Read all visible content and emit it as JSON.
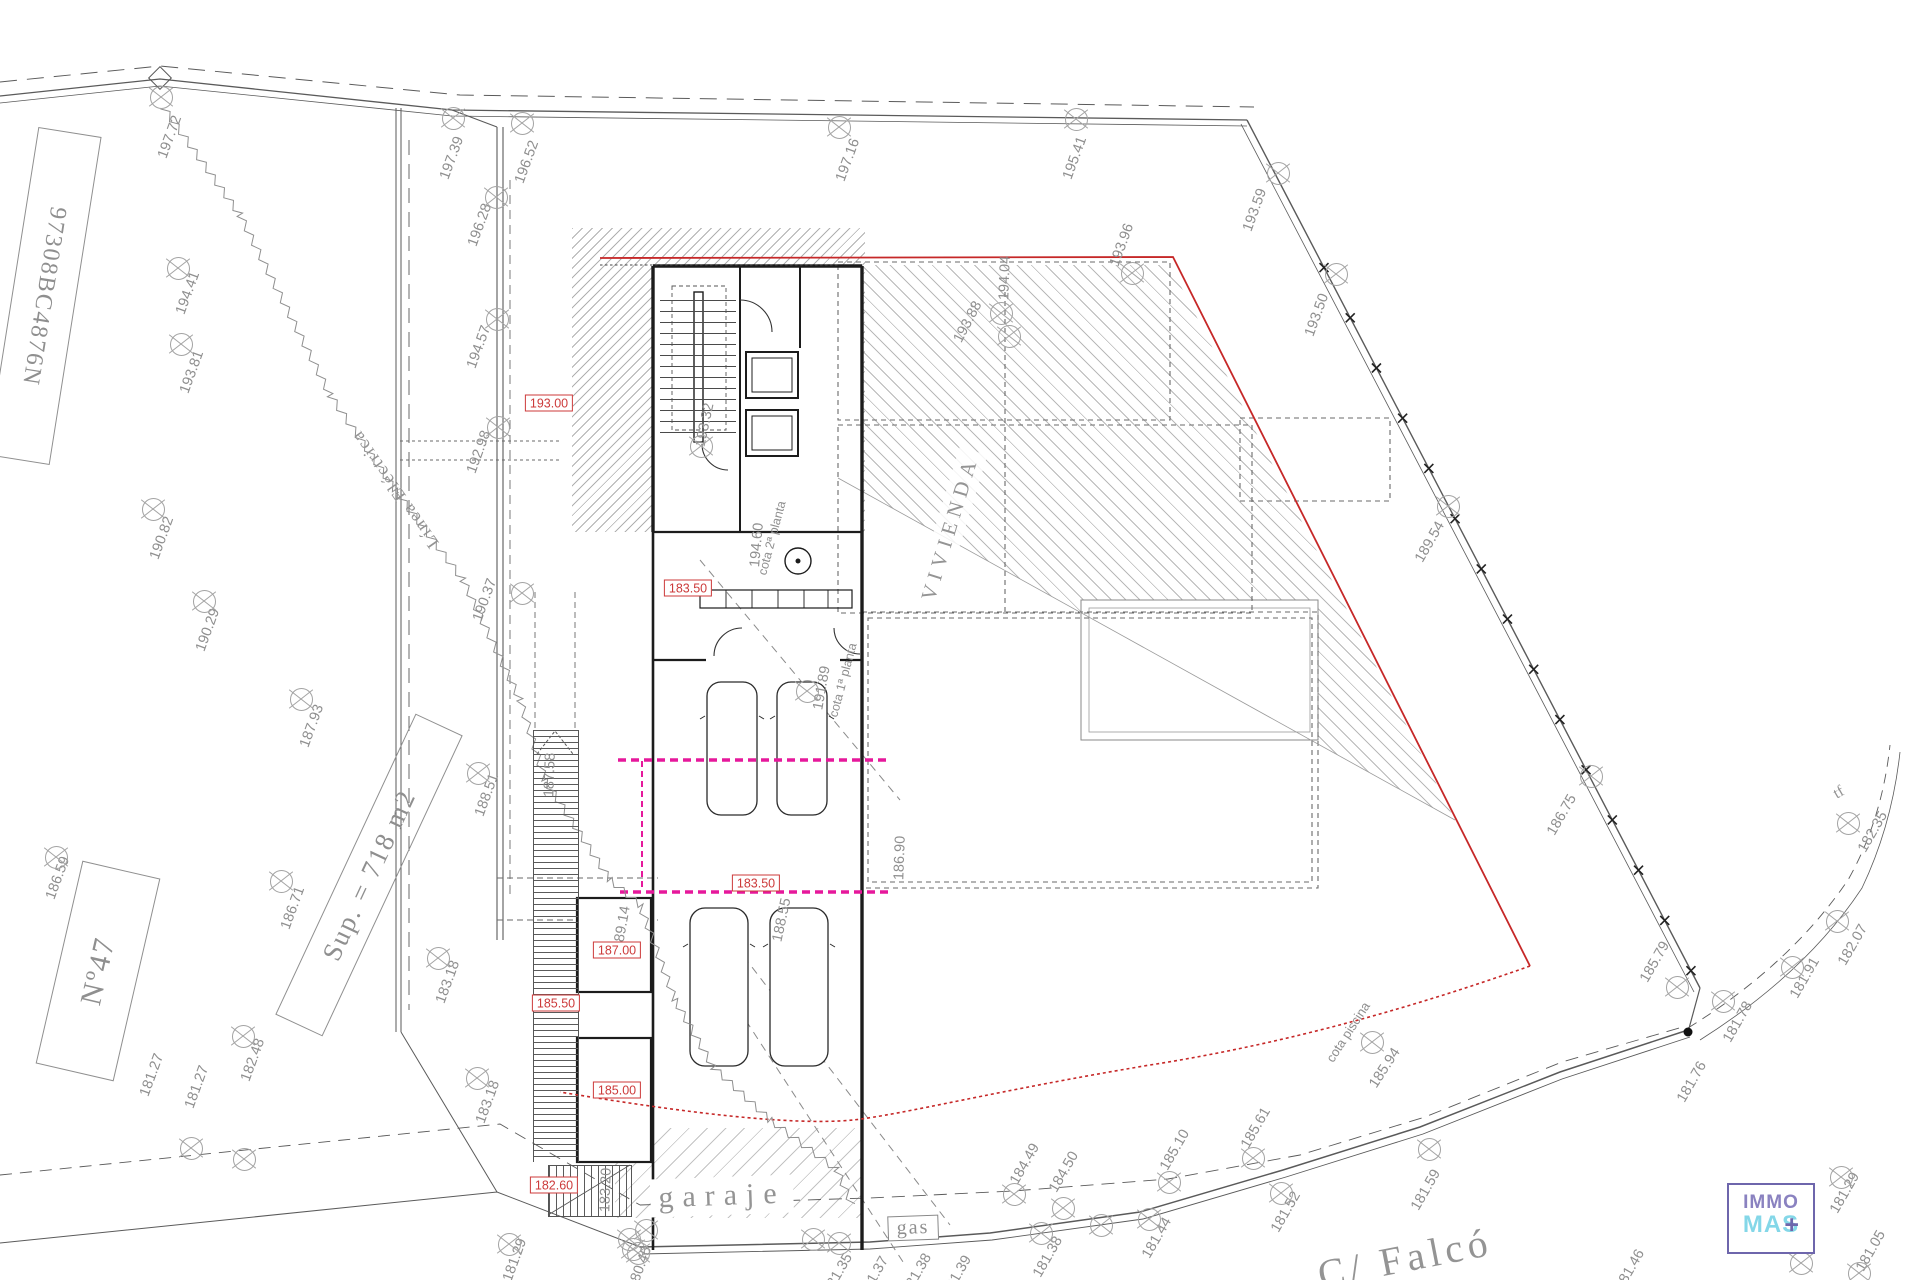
{
  "texts": {
    "vivienda": "VIVIENDA",
    "garaje": "garaje",
    "gas": "gas",
    "street": "C/ Falcó",
    "linea_electrica": "Línea Eléctrica",
    "cota_piscina": "cota piscina",
    "cota_1": "cota 1ª planta",
    "cota_2": "cota 2ª planta",
    "sup": "Sup. = 718 m2",
    "parcel_no": "Nº47",
    "cadastral": "97308BC4876N",
    "tf": "tf"
  },
  "logo": {
    "top": "IMMO",
    "bottom": "MAS",
    "plus": "+"
  },
  "colors": {
    "red": "#c62828",
    "magenta": "#e6189b",
    "label_gray": "#8f8f8f",
    "logo_purple": "#7c74b8",
    "logo_cyan": "#84d7e8"
  },
  "red_levels": [
    {
      "t": "193.00",
      "x": 549,
      "y": 403
    },
    {
      "t": "183.50",
      "x": 688,
      "y": 588
    },
    {
      "t": "183.50",
      "x": 756,
      "y": 883
    },
    {
      "t": "187.00",
      "x": 617,
      "y": 950
    },
    {
      "t": "185.50",
      "x": 556,
      "y": 1003
    },
    {
      "t": "185.00",
      "x": 617,
      "y": 1090
    },
    {
      "t": "182.60",
      "x": 554,
      "y": 1185
    }
  ],
  "elevations": [
    {
      "t": "197.72",
      "x": 170,
      "y": 137,
      "r": -70,
      "mx": 160,
      "my": 96
    },
    {
      "t": "197.39",
      "x": 452,
      "y": 158,
      "r": -70,
      "mx": 452,
      "my": 117
    },
    {
      "t": "196.52",
      "x": 527,
      "y": 162,
      "r": -70,
      "mx": 521,
      "my": 122
    },
    {
      "t": "196.28",
      "x": 480,
      "y": 225,
      "r": -70,
      "mx": 495,
      "my": 196
    },
    {
      "t": "197.16",
      "x": 848,
      "y": 160,
      "r": -70,
      "mx": 838,
      "my": 126
    },
    {
      "t": "195.41",
      "x": 1075,
      "y": 158,
      "r": -70,
      "mx": 1075,
      "my": 118
    },
    {
      "t": "193.59",
      "x": 1255,
      "y": 210,
      "r": -70,
      "mx": 1277,
      "my": 172
    },
    {
      "t": "193.50",
      "x": 1317,
      "y": 315,
      "r": -70,
      "mx": 1335,
      "my": 273
    },
    {
      "t": "194.41",
      "x": 188,
      "y": 293,
      "r": -70,
      "mx": 177,
      "my": 267
    },
    {
      "t": "193.81",
      "x": 192,
      "y": 372,
      "r": -70,
      "mx": 180,
      "my": 343
    },
    {
      "t": "194.57",
      "x": 479,
      "y": 347,
      "r": -70,
      "mx": 496,
      "my": 318
    },
    {
      "t": "192.98",
      "x": 479,
      "y": 452,
      "r": -70,
      "mx": 497,
      "my": 426
    },
    {
      "t": "190.82",
      "x": 162,
      "y": 538,
      "r": -70,
      "mx": 152,
      "my": 508
    },
    {
      "t": "190.29",
      "x": 208,
      "y": 630,
      "r": -70,
      "mx": 203,
      "my": 600
    },
    {
      "t": "190.37",
      "x": 485,
      "y": 600,
      "r": -70,
      "mx": 521,
      "my": 592
    },
    {
      "t": "187.93",
      "x": 312,
      "y": 726,
      "r": -70,
      "mx": 300,
      "my": 698
    },
    {
      "t": "188.51",
      "x": 487,
      "y": 795,
      "r": -70,
      "mx": 477,
      "my": 772
    },
    {
      "t": "186.59",
      "x": 58,
      "y": 878,
      "r": -70,
      "mx": 55,
      "my": 856
    },
    {
      "t": "186.71",
      "x": 293,
      "y": 908,
      "r": -70,
      "mx": 280,
      "my": 880
    },
    {
      "t": "182.48",
      "x": 253,
      "y": 1060,
      "r": -70,
      "mx": 242,
      "my": 1035
    },
    {
      "t": "183.18",
      "x": 448,
      "y": 982,
      "r": -70,
      "mx": 437,
      "my": 957
    },
    {
      "t": "183.18",
      "x": 488,
      "y": 1102,
      "r": -70,
      "mx": 476,
      "my": 1077
    },
    {
      "t": "181.27",
      "x": 152,
      "y": 1075,
      "r": -70,
      "mx": 190,
      "my": 1147
    },
    {
      "t": "181.27",
      "x": 197,
      "y": 1087,
      "r": -70,
      "mx": 243,
      "my": 1158
    },
    {
      "t": "181.29",
      "x": 515,
      "y": 1260,
      "r": -70,
      "mx": 508,
      "my": 1243
    },
    {
      "t": "180.45",
      "x": 640,
      "y": 1268,
      "r": -70,
      "mx": 632,
      "my": 1248
    },
    {
      "t": "183.20",
      "x": 606,
      "y": 1190,
      "r": -88
    },
    {
      "t": "189.14",
      "x": 622,
      "y": 928,
      "r": -80
    },
    {
      "t": "188.55",
      "x": 782,
      "y": 920,
      "r": -78
    },
    {
      "t": "186.90",
      "x": 900,
      "y": 858,
      "r": -88
    },
    {
      "t": "187.58",
      "x": 550,
      "y": 775,
      "r": -88
    },
    {
      "t": "193.32",
      "x": 705,
      "y": 425,
      "r": -78,
      "mx": 700,
      "my": 445
    },
    {
      "t": "194.60",
      "x": 757,
      "y": 545,
      "r": -85
    },
    {
      "t": "191.89",
      "x": 822,
      "y": 688,
      "r": -80,
      "mx": 806,
      "my": 690
    },
    {
      "t": "193.88",
      "x": 968,
      "y": 322,
      "r": -62,
      "mx": 1000,
      "my": 312
    },
    {
      "t": "194.04",
      "x": 1005,
      "y": 278,
      "r": -88,
      "mx": 1008,
      "my": 335
    },
    {
      "t": "193.96",
      "x": 1122,
      "y": 245,
      "r": -70,
      "mx": 1131,
      "my": 272
    },
    {
      "t": "189.54",
      "x": 1430,
      "y": 542,
      "r": -60,
      "mx": 1447,
      "my": 505
    },
    {
      "t": "186.75",
      "x": 1562,
      "y": 815,
      "r": -60,
      "mx": 1590,
      "my": 775
    },
    {
      "t": "185.79",
      "x": 1655,
      "y": 962,
      "r": -60,
      "mx": 1676,
      "my": 986
    },
    {
      "t": "181.78",
      "x": 1738,
      "y": 1022,
      "r": -60,
      "mx": 1722,
      "my": 1000
    },
    {
      "t": "181.76",
      "x": 1692,
      "y": 1082,
      "r": -60
    },
    {
      "t": "181.91",
      "x": 1805,
      "y": 978,
      "r": -60,
      "mx": 1791,
      "my": 966
    },
    {
      "t": "182.07",
      "x": 1853,
      "y": 945,
      "r": -60,
      "mx": 1836,
      "my": 920
    },
    {
      "t": "182.35",
      "x": 1873,
      "y": 832,
      "r": -60,
      "mx": 1847,
      "my": 822
    },
    {
      "t": "185.94",
      "x": 1385,
      "y": 1068,
      "r": -57,
      "mx": 1371,
      "my": 1041
    },
    {
      "t": "184.49",
      "x": 1025,
      "y": 1164,
      "r": -60,
      "mx": 1013,
      "my": 1193
    },
    {
      "t": "184.50",
      "x": 1064,
      "y": 1172,
      "r": -60,
      "mx": 1062,
      "my": 1207
    },
    {
      "t": "185.10",
      "x": 1175,
      "y": 1150,
      "r": -60,
      "mx": 1168,
      "my": 1181
    },
    {
      "t": "185.61",
      "x": 1256,
      "y": 1128,
      "r": -60,
      "mx": 1252,
      "my": 1157
    },
    {
      "t": "181.38",
      "x": 1048,
      "y": 1257,
      "r": -60,
      "mx": 1040,
      "my": 1232
    },
    {
      "t": "181.44",
      "x": 1157,
      "y": 1238,
      "r": -60,
      "mx": 1148,
      "my": 1218
    },
    {
      "t": "181.52",
      "x": 1286,
      "y": 1212,
      "r": -60,
      "mx": 1280,
      "my": 1192
    },
    {
      "t": "181.59",
      "x": 1426,
      "y": 1190,
      "r": -60,
      "mx": 1428,
      "my": 1148
    },
    {
      "t": "181.29",
      "x": 1845,
      "y": 1193,
      "r": -60,
      "mx": 1840,
      "my": 1176
    },
    {
      "t": "181.26",
      "x": 1790,
      "y": 1230,
      "r": -65,
      "mx": 1800,
      "my": 1262
    },
    {
      "t": "181.05",
      "x": 1871,
      "y": 1251,
      "r": -60,
      "mx": 1858,
      "my": 1272
    },
    {
      "t": "181.46",
      "x": 1630,
      "y": 1270,
      "r": -60
    },
    {
      "t": "181.35",
      "x": 838,
      "y": 1274,
      "r": -60,
      "mx": 838,
      "my": 1242
    },
    {
      "t": "181.37",
      "x": 874,
      "y": 1277,
      "r": -60
    },
    {
      "t": "181.38",
      "x": 917,
      "y": 1274,
      "r": -60
    },
    {
      "t": "181.39",
      "x": 957,
      "y": 1276,
      "r": -60
    }
  ],
  "extra_markers": [
    [
      628,
      1238
    ],
    [
      645,
      1229
    ],
    [
      637,
      1252
    ],
    [
      812,
      1238
    ],
    [
      1100,
      1224
    ]
  ],
  "geometry": {
    "fence": [
      1247,
      120,
      1700,
      988
    ],
    "fence_ticks": 15,
    "zigzag": [
      [
        163,
        107
      ],
      [
        240,
        215
      ],
      [
        330,
        395
      ],
      [
        395,
        490
      ],
      [
        463,
        580
      ],
      [
        520,
        700
      ],
      [
        545,
        780
      ],
      [
        610,
        880
      ],
      [
        640,
        905
      ],
      [
        675,
        1000
      ],
      [
        713,
        1067
      ],
      [
        770,
        1120
      ],
      [
        837,
        1170
      ],
      [
        852,
        1205
      ]
    ]
  }
}
